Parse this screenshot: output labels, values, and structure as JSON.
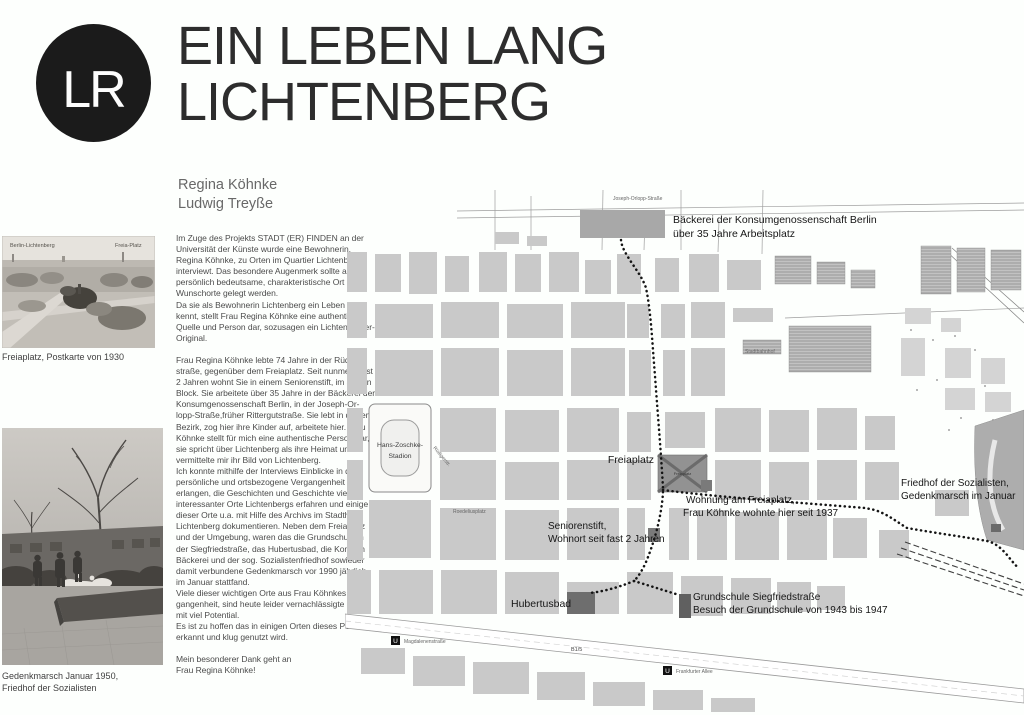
{
  "colors": {
    "page_bg": "#fdfffd",
    "ink": "#1b1b1b",
    "body_text": "#4c4c4c",
    "author_gray": "#686868",
    "map_building": "#c9c9c9",
    "map_poi_dark": "#6e6e6e",
    "map_park": "#929292",
    "route_dots": "#141414"
  },
  "header": {
    "logo_initials": "LR",
    "title_line1": "EIN LEBEN LANG",
    "title_line2": "LICHTENBERG",
    "author1": "Regina Köhnke",
    "author2": "Ludwig Treyße"
  },
  "photos": {
    "photo1": {
      "overlay_left": "Berlin-Lichtenberg",
      "overlay_right": "Freia-Platz",
      "caption": "Freiaplatz, Postkarte von 1930"
    },
    "photo2": {
      "caption": "Gedenkmarsch Januar 1950,\nFriedhof der Sozialisten"
    }
  },
  "article": {
    "p1": "Im Zuge des Projekts STADT (ER) FINDEN an der\nUniversität der Künste wurde eine Bewohnerin,\nRegina Köhnke, zu Orten im Quartier Lichtenberg\ninterviewt. Das besondere Augenmerk sollte auf\npersönlich bedeutsame, charakteristische Ort und\nWunschorte gelegt werden.\nDa sie als Bewohnerin Lichtenberg ein Leben lang\nkennt, stellt Frau Regina Köhnke eine authentische\nQuelle und Person dar, sozusagen ein Lichtenberger-\nOriginal.",
    "p2": "Frau Regina Köhnke lebte 74 Jahre in der Rüdiger-\nstraße, gegenüber dem Freiaplatz. Seit nunmehr fast\n2 Jahren wohnt Sie in einem Seniorenstift, im selben\nBlock. Sie arbeitete über 35 Jahre in der Bäckerei der\nKonsumgenossenschaft Berlin, in der Joseph-Or-\nlopp-Straße,früher Rittergutstraße. Sie lebt in diesem\nBezirk, zog hier ihre Kinder auf, arbeitete hier. Frau\nKöhnke stellt für mich eine authentische Person dar,\nsie spricht über Lichtenberg als ihre Heimat und\nvermittelte mir ihr Bild von Lichtenberg.\nIch konnte mithilfe der Interviews Einblicke in die\npersönliche und ortsbezogene Vergangenheit\nerlangen, die Geschichten und Geschichte vieler\ninteressanter Orte Lichtenbergs erfahren und einige\ndieser Orte u.a. mit Hilfe des Archivs im Stadthaus\nLichtenberg dokumentieren. Neben dem Freiaplatz\nund der Umgebung, waren das die Grundschule in\nder Siegfriedstraße, das Hubertusbad, die Konsum\nBäckerei und der sog. Sozialistenfriedhof sowieder\ndamit verbundene Gedenkmarsch vor 1990 jährlich\nim Januar stattfand.\nViele dieser wichtigen Orte aus Frau Köhnkes Ver-\ngangenheit, sind heute leider vernachlässigte Orte\nmit viel Potential.\nEs ist zu hoffen das in einigen Orten dieses Potential\nerkannt und klug genutzt wird.",
    "p3": "Mein besonderer Dank geht an\nFrau Regina Köhnke!"
  },
  "map": {
    "labels": {
      "bakery1": "Bäckerei der Konsumgenossenschaft Berlin",
      "bakery2": "über 35 Jahre Arbeitsplatz",
      "joseph_orlopp": "Joseph-Orlopp-Straße",
      "freiaplatz": "Freiaplatz",
      "freiaplatz_small": "Freiaplatz",
      "wohnung1": "Wohnung am Freiaplatz,",
      "wohnung2": "Frau Köhnke wohnte hier seit 1937",
      "seniorenstift1": "Seniorenstift,",
      "seniorenstift2": "Wohnort seit fast 2 Jahren",
      "hubertusbad": "Hubertusbad",
      "grundschule1": "Grundschule Siegfriedstraße",
      "grundschule2": "Besuch der Grundschule von 1943 bis 1947",
      "friedhof1": "Friedhof der Sozialisten,",
      "friedhof2": "Gedenkmarsch im Januar",
      "stadion1": "Hans-Zoschke-",
      "stadion2": "Stadion",
      "ruediger": "Rüdigerstr.",
      "roedelius": "Roedeliusplatz",
      "stadtbahnhof": "Stadtbahnhof",
      "b15": "B1/5",
      "u1": "U",
      "u1_label": "Magdalenenstraße",
      "u2": "U",
      "u2_label": "Frankfurter Allee"
    }
  }
}
